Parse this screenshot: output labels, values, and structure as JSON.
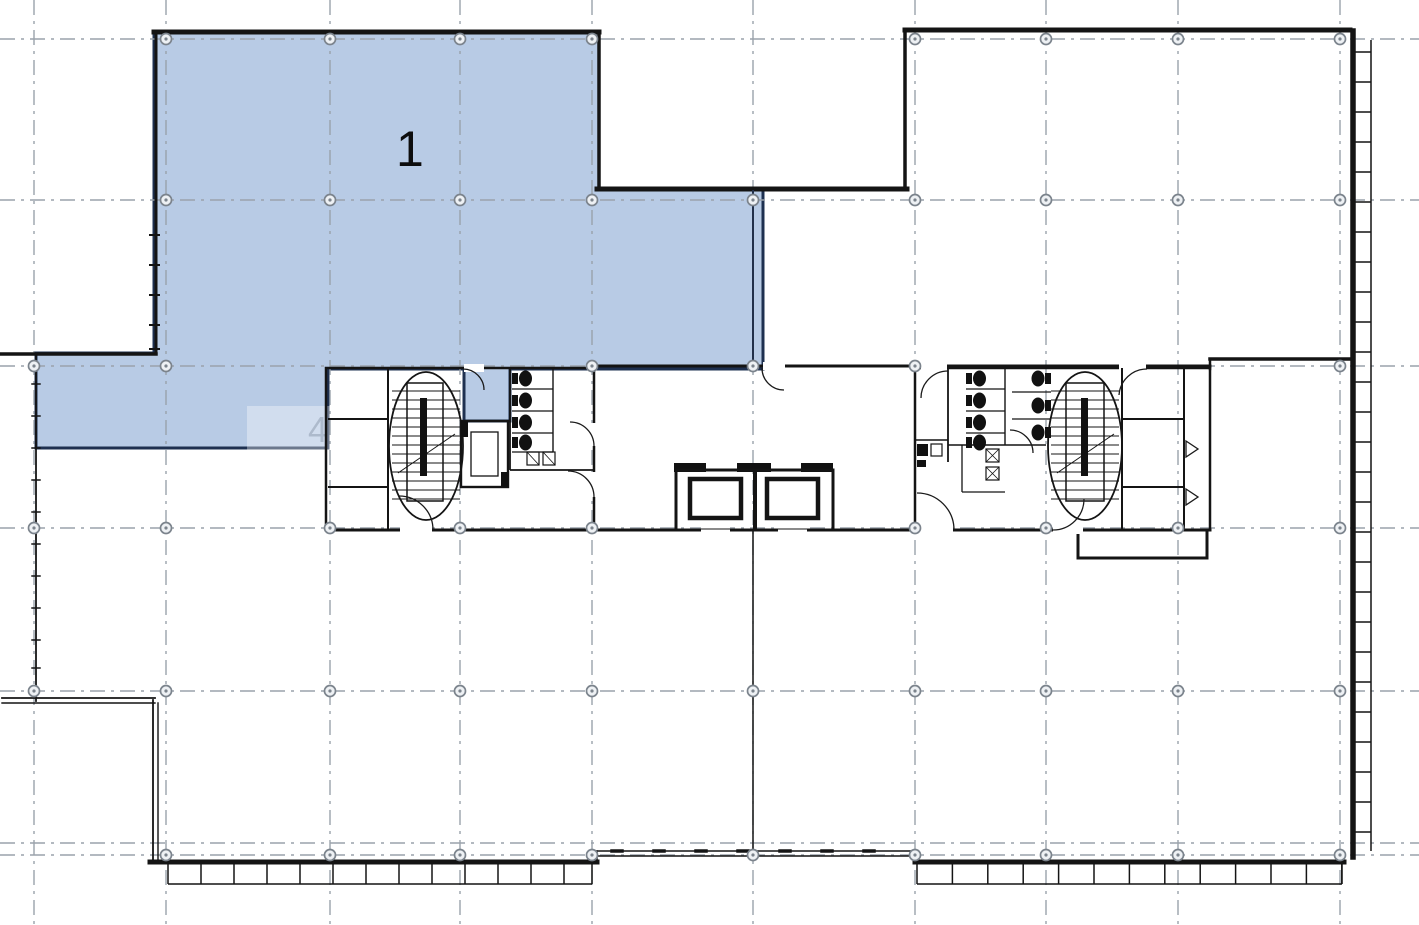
{
  "document": {
    "title": "Office floor plan with highlighted lease zone",
    "background": "#ffffff"
  },
  "zones": [
    {
      "id": "zone-1",
      "label": "1",
      "fill": "#aec4e1",
      "border": "#1e3050",
      "opacity": "0.88"
    },
    {
      "id": "zone-4-faint",
      "label": "4",
      "fill": "#7d8b9e",
      "opacity": "0.42"
    }
  ],
  "colors": {
    "wall": "#141414",
    "wall_navy": "#22304a",
    "grid_line": "#9aa2ab",
    "node_fill": "#eef1f4",
    "node_stroke": "#7b838c",
    "fixture": "#111111",
    "background": "#ffffff"
  },
  "grid": {
    "dash": "15 6 3 6",
    "vertical_x": [
      34,
      166,
      330,
      460,
      592,
      753,
      915,
      1046,
      1178,
      1340
    ],
    "horizontal_y": [
      39,
      200,
      366,
      528,
      691,
      843,
      855
    ],
    "nodes": [
      [
        166,
        39
      ],
      [
        330,
        39
      ],
      [
        460,
        39
      ],
      [
        592,
        39
      ],
      [
        915,
        39
      ],
      [
        1046,
        39
      ],
      [
        1178,
        39
      ],
      [
        1340,
        39
      ],
      [
        166,
        200
      ],
      [
        330,
        200
      ],
      [
        460,
        200
      ],
      [
        592,
        200
      ],
      [
        753,
        200
      ],
      [
        915,
        200
      ],
      [
        1046,
        200
      ],
      [
        1178,
        200
      ],
      [
        1340,
        200
      ],
      [
        34,
        366
      ],
      [
        166,
        366
      ],
      [
        592,
        366
      ],
      [
        753,
        366
      ],
      [
        915,
        366
      ],
      [
        1340,
        366
      ],
      [
        34,
        528
      ],
      [
        166,
        528
      ],
      [
        330,
        528
      ],
      [
        460,
        528
      ],
      [
        592,
        528
      ],
      [
        915,
        528
      ],
      [
        1046,
        528
      ],
      [
        1178,
        528
      ],
      [
        1340,
        528
      ],
      [
        34,
        691
      ],
      [
        166,
        691
      ],
      [
        330,
        691
      ],
      [
        460,
        691
      ],
      [
        592,
        691
      ],
      [
        753,
        691
      ],
      [
        915,
        691
      ],
      [
        1046,
        691
      ],
      [
        1178,
        691
      ],
      [
        1340,
        691
      ],
      [
        166,
        855
      ],
      [
        330,
        855
      ],
      [
        460,
        855
      ],
      [
        592,
        855
      ],
      [
        753,
        855
      ],
      [
        915,
        855
      ],
      [
        1046,
        855
      ],
      [
        1178,
        855
      ],
      [
        1340,
        855
      ]
    ]
  },
  "ladders": [
    {
      "name": "right-facade-mullions",
      "dir": "v",
      "x1": 1353,
      "x2": 1371,
      "from": 40,
      "to": 851,
      "step": 30,
      "offset": 12
    },
    {
      "name": "bottom-left-mullions",
      "dir": "h",
      "y1": 864,
      "y2": 884,
      "from": 168,
      "to": 592,
      "step": 33,
      "offset": 0
    },
    {
      "name": "bottom-right-mullions",
      "dir": "h",
      "y1": 864,
      "y2": 884,
      "from": 917,
      "to": 1342,
      "step": 35.4,
      "offset": 0
    }
  ]
}
